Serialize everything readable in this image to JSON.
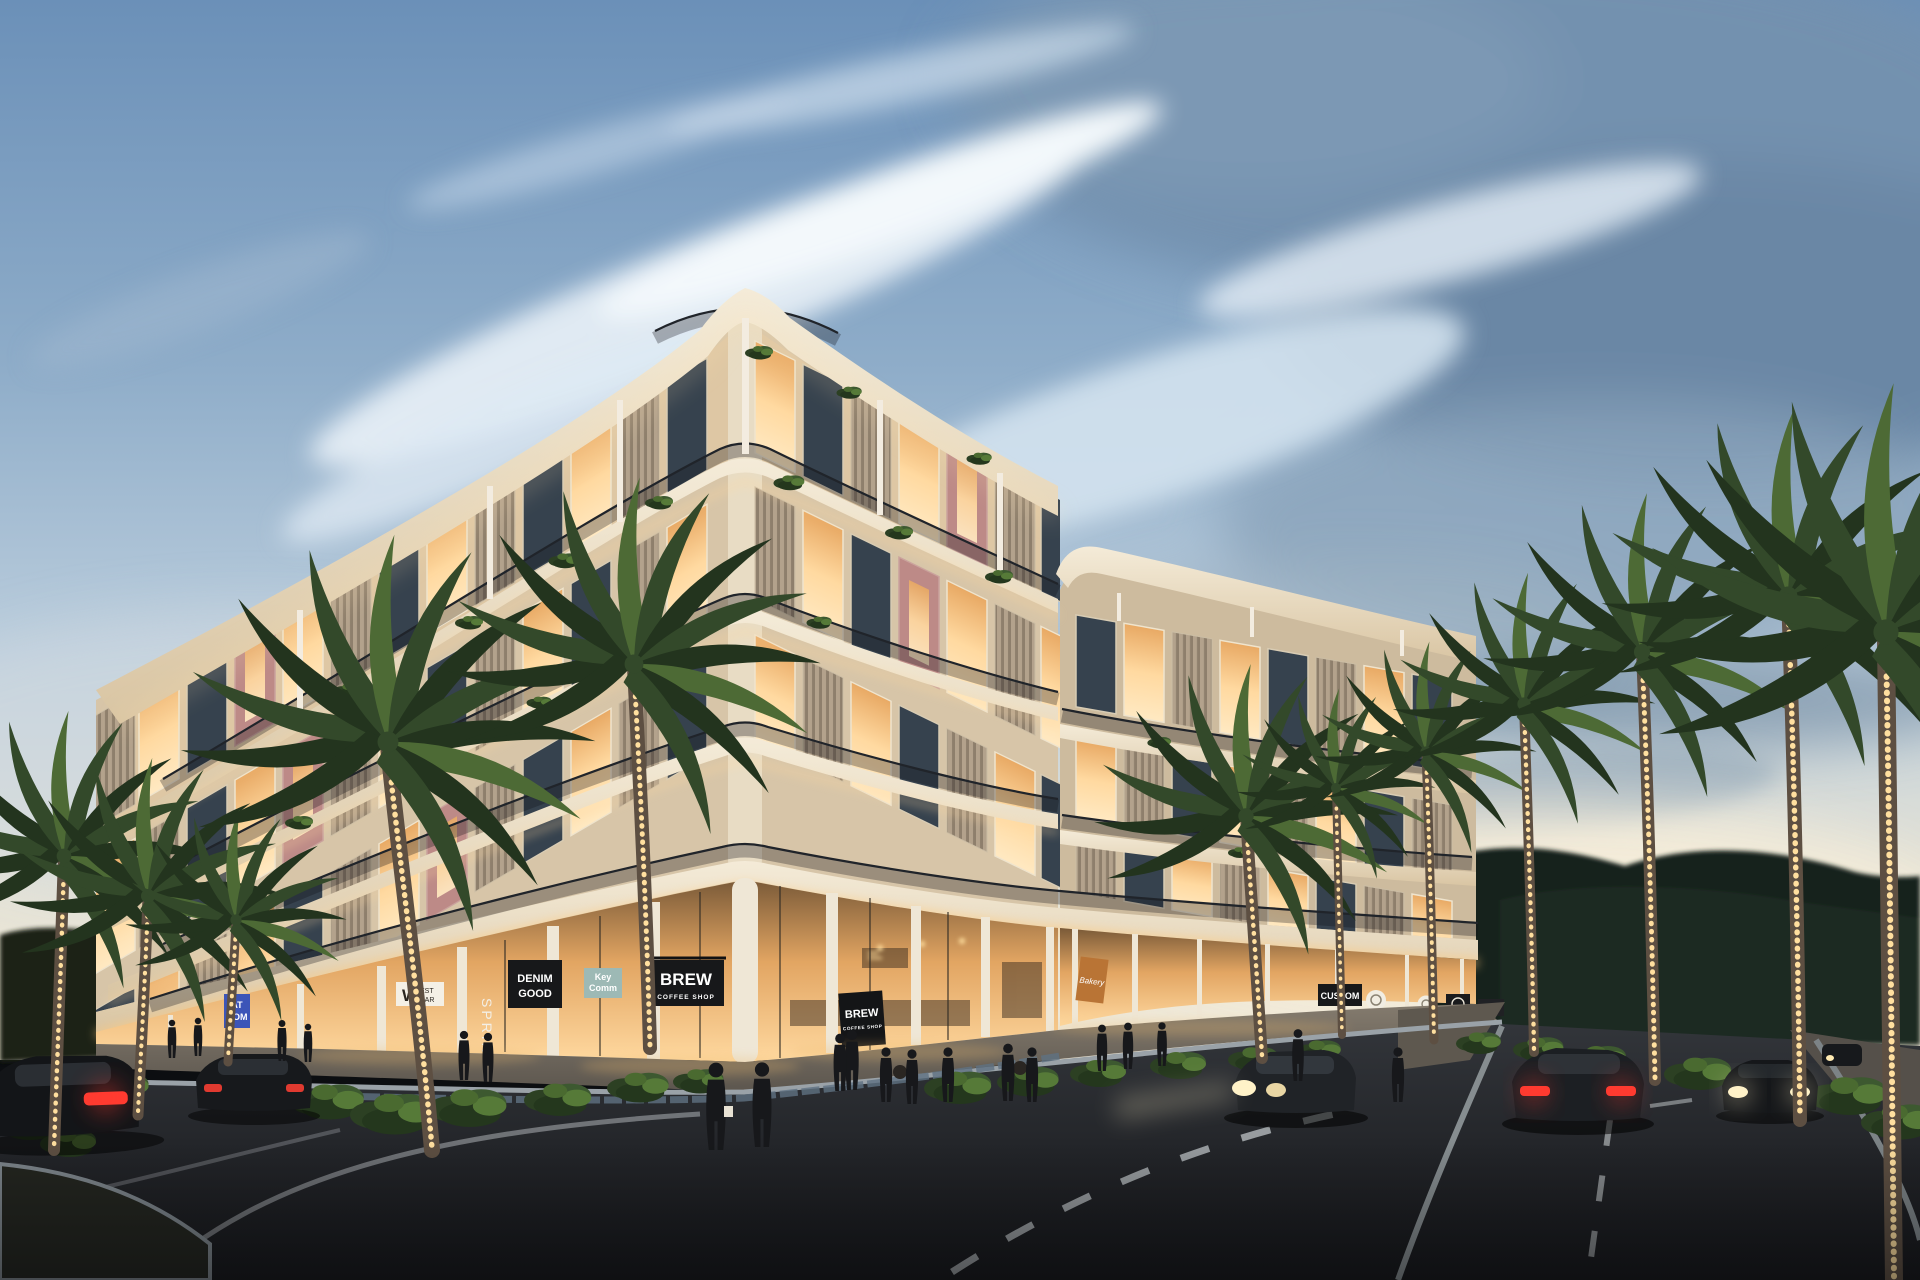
{
  "scene": {
    "description": "Twilight architectural rendering of a four-storey curved mixed-use building with ground-floor retail, string-lit palm trees, pedestrians and cars on a street corner",
    "time_of_day": "dusk"
  },
  "palette": {
    "sky_top": "#6b90b8",
    "sky_mid": "#9db8d2",
    "sky_horizon": "#f2ead8",
    "cloud_dark": "#6a87a5",
    "cloud_light": "#e9f1f7",
    "building_cream": "#d7c5a8",
    "slab_cream": "#f0e5cf",
    "wood_slat": "#b3a28c",
    "accent_pink": "#bd8a87",
    "window_warm": "#ffd9a0",
    "window_dark": "#36424e",
    "railing_dark": "#20242a",
    "retail_glow": "#ffc87d",
    "plant_dark": "#2c4023",
    "plant_light": "#567a38",
    "palm_trunk": "#5d4f42",
    "string_lights": "#ffdf9f",
    "road": "#26282c",
    "marking_white": "#c9ced1",
    "taillight_red": "#ff3b30",
    "headlight_warm": "#fff2c8",
    "sign_black": "#17181a",
    "sign_teal": "#9db9b5",
    "sign_blue": "#3c55b8",
    "sign_orange": "#b97435"
  },
  "signs": {
    "west_boutique": {
      "initial": "W",
      "line1": "EST",
      "line2": "BAR"
    },
    "denim": {
      "line1": "DENIM",
      "line2": "GOOD"
    },
    "spring_vertical": {
      "text": "SPRING"
    },
    "key_comm": {
      "line1": "Key",
      "line2": "Comm"
    },
    "brew_main": {
      "name": "BREW",
      "tagline": "COFFEE SHOP"
    },
    "brew_corner": {
      "name": "BREW",
      "tagline": "COFFEE SHOP"
    },
    "bakery": {
      "text": "Bakery"
    },
    "at_com": {
      "line1": "AT",
      "line2": "COM"
    },
    "custom": {
      "text": "CUSTOM"
    }
  }
}
